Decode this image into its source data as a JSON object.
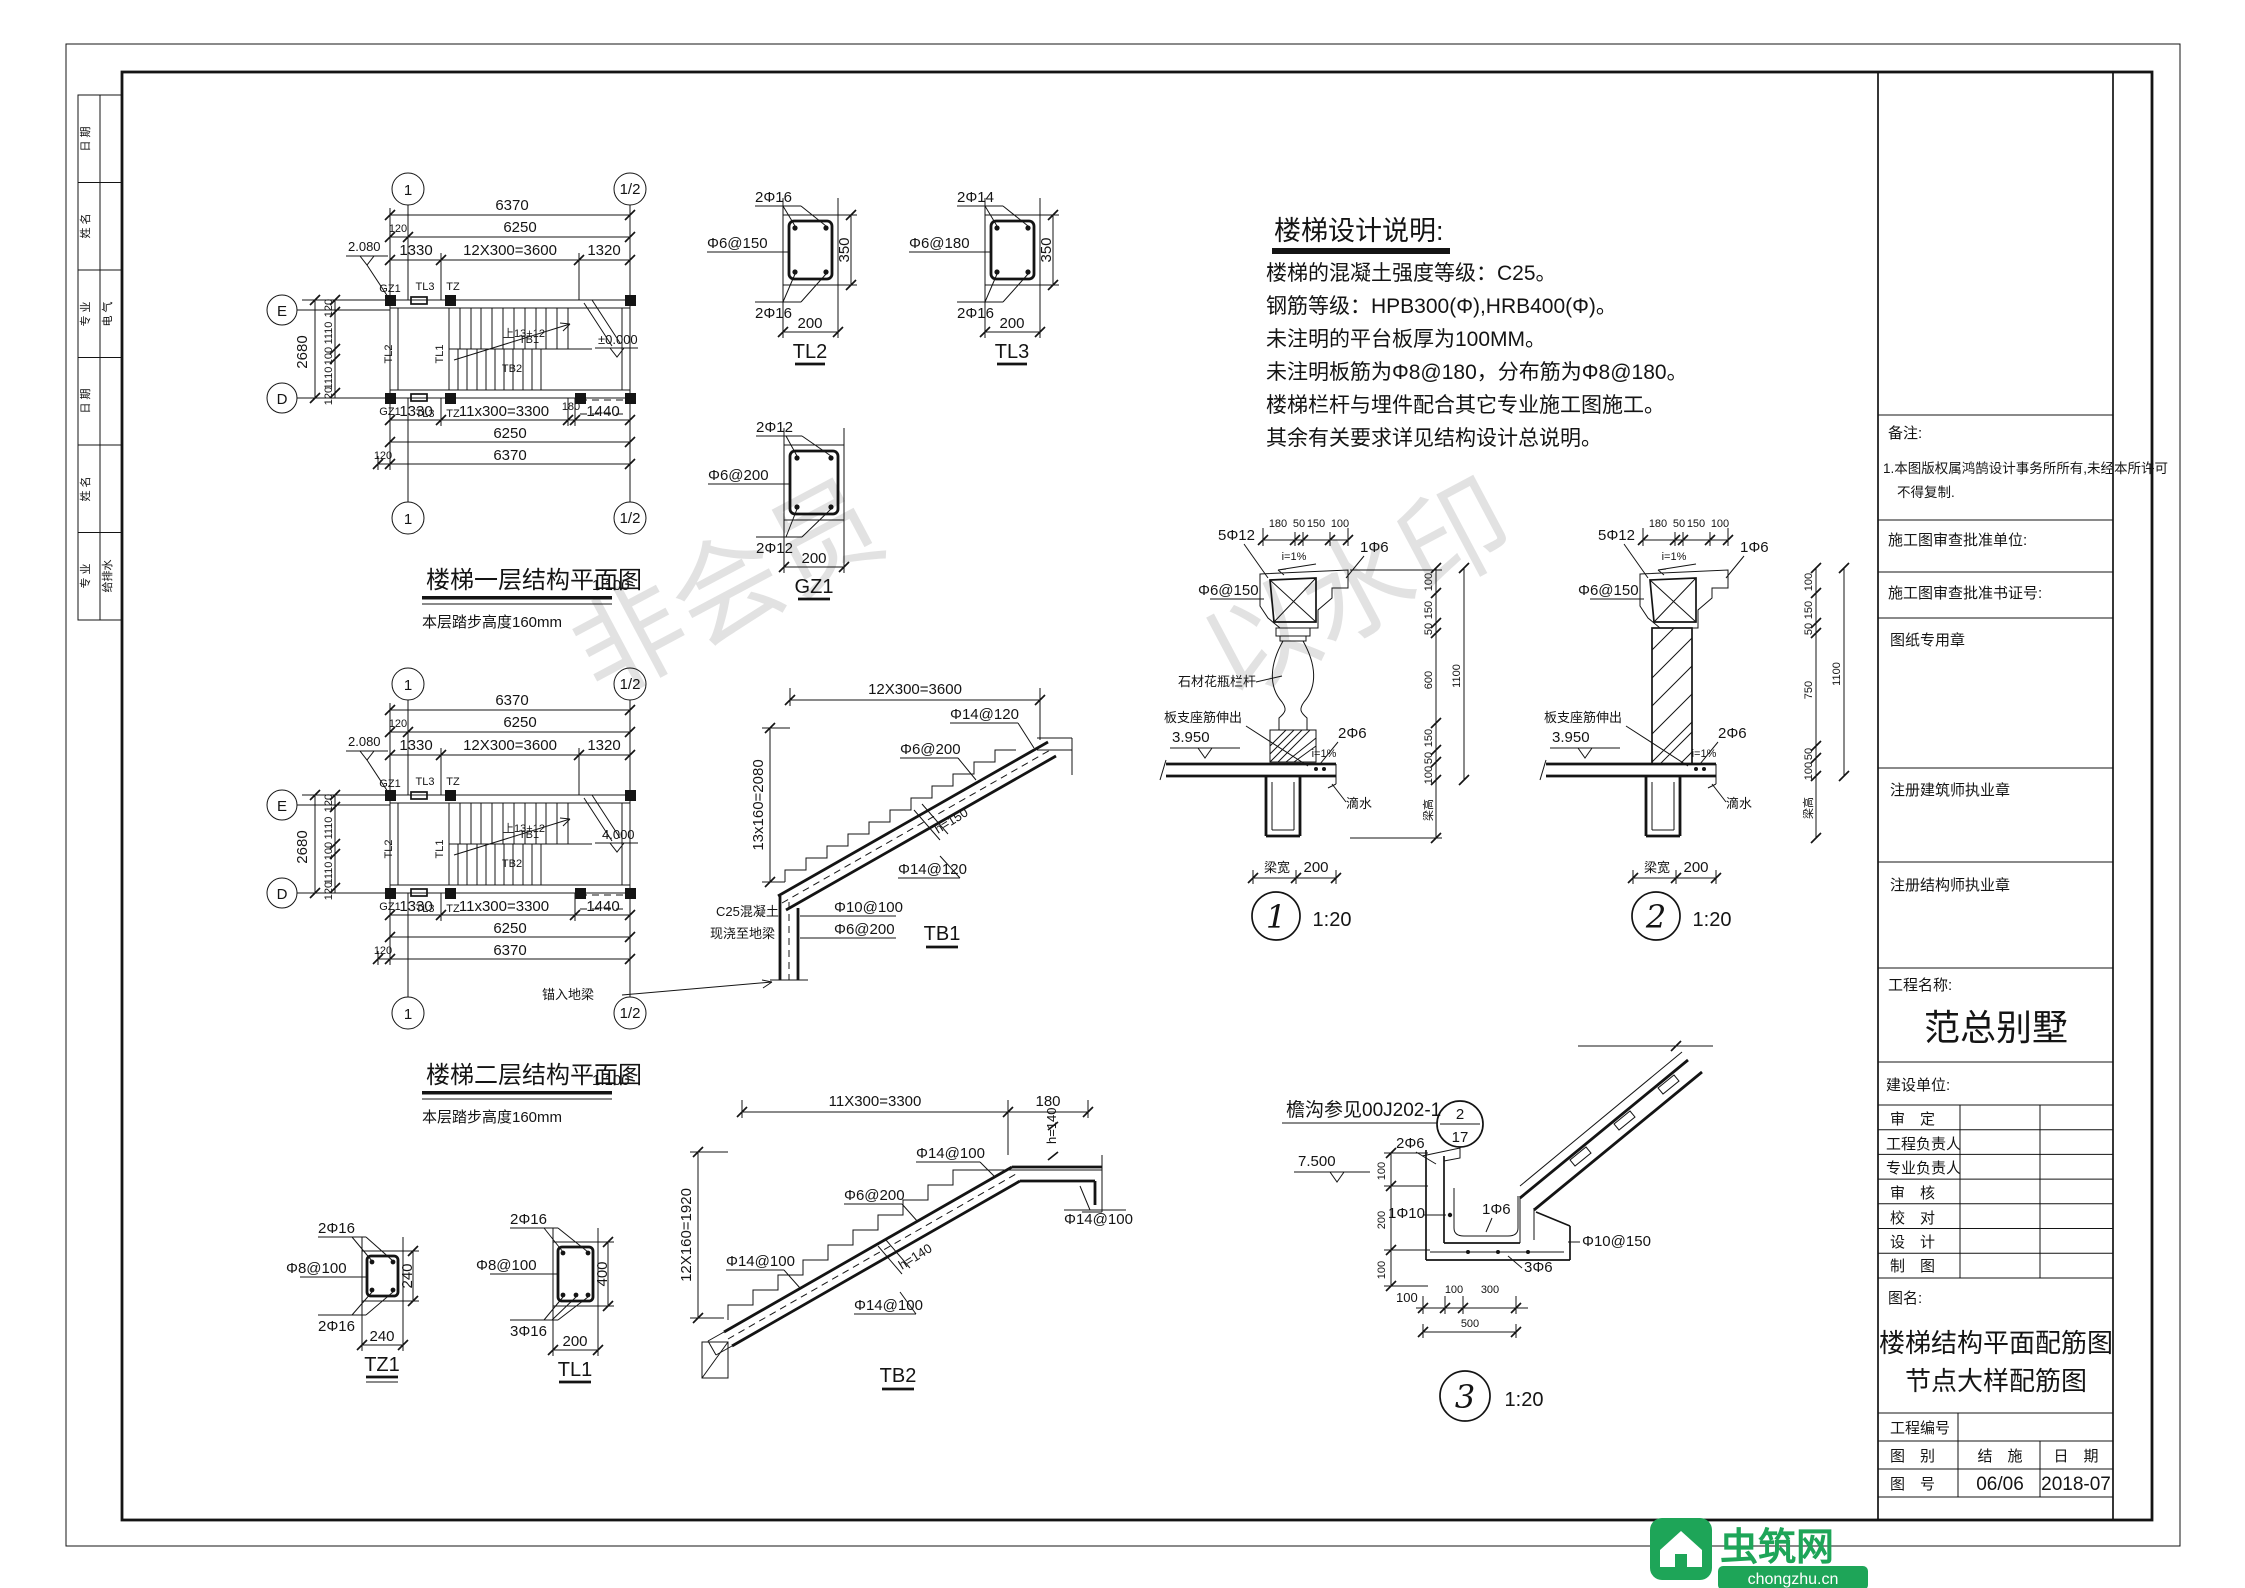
{
  "sheet": {
    "watermarks": [
      "非会员",
      "以水印"
    ]
  },
  "left_strip": {
    "rows": [
      {
        "label": "日 期",
        "value": ""
      },
      {
        "label": "姓 名",
        "value": ""
      },
      {
        "label": "专 业",
        "value": "电 气"
      },
      {
        "label": "日 期",
        "value": ""
      },
      {
        "label": "姓 名",
        "value": ""
      },
      {
        "label": "专 业",
        "value": "给排水"
      }
    ]
  },
  "plan_grid": {
    "one": "1",
    "half": "1/2",
    "e": "E",
    "d": "D"
  },
  "plan1": {
    "title": "楼梯一层结构平面图",
    "scale": "1:100",
    "subtitle": "本层踏步高度160mm",
    "elev": "2.080",
    "dims_top": [
      "6370",
      "120",
      "6250",
      "1330",
      "12X300=3600",
      "1320"
    ],
    "dims_left": [
      "2680",
      "120",
      "1110",
      "100",
      "1110",
      "120"
    ],
    "dims_bottom": [
      "1330",
      "11x300=3300",
      "180",
      "1440",
      "6250",
      "120",
      "6370"
    ],
    "labels": {
      "gz1": "GZ1",
      "tl3": "TL3",
      "tz": "TZ",
      "tl2": "TL2",
      "tl1": "TL1",
      "tb1": "TB1",
      "tb2": "TB2",
      "up": "上13+12",
      "level": "±0.000"
    }
  },
  "plan2": {
    "title": "楼梯二层结构平面图",
    "scale": "1:100",
    "subtitle": "本层踏步高度160mm",
    "elev": "2.080",
    "dims_top": [
      "6370",
      "120",
      "6250",
      "1330",
      "12X300=3600",
      "1320"
    ],
    "dims_left": [
      "2680",
      "120",
      "1110",
      "100",
      "1110",
      "120"
    ],
    "dims_bottom": [
      "1330",
      "11x300=3300",
      "",
      "1440",
      "6250",
      "120",
      "6370"
    ],
    "labels": {
      "gz1": "GZ1",
      "tl3": "TL3",
      "tz": "TZ",
      "tl2": "TL2",
      "tl1": "TL1",
      "tb1": "TB1",
      "tb2": "TB2",
      "up": "上13+12",
      "level": "4.000"
    }
  },
  "sections": {
    "tl2": {
      "top": "2Φ16",
      "stirrup": "Φ6@150",
      "h": "350",
      "bottom": "2Φ16",
      "w": "200",
      "name": "TL2"
    },
    "tl3": {
      "top": "2Φ14",
      "stirrup": "Φ6@180",
      "h": "350",
      "bottom": "2Φ16",
      "w": "200",
      "name": "TL3"
    },
    "gz1": {
      "top": "2Φ12",
      "stirrup": "Φ6@200",
      "bottom": "2Φ12",
      "w": "200",
      "name": "GZ1"
    },
    "tz1": {
      "top": "2Φ16",
      "stirrup": "Φ8@100",
      "h": "240",
      "bottom": "2Φ16",
      "w": "240",
      "name": "TZ1"
    },
    "tl1": {
      "top": "2Φ16",
      "stirrup": "Φ8@100",
      "h": "400",
      "bottom": "3Φ16",
      "w": "200",
      "name": "TL1"
    }
  },
  "tb1": {
    "dim_top": "12X300=3600",
    "dim_left": "13x160=2080",
    "bar_top": "Φ14@120",
    "stirrup": "Φ6@200",
    "h": "h=150",
    "bar_bot": "Φ14@120",
    "wall_bar1": "Φ10@100",
    "wall_bar2": "Φ6@200",
    "note1": "C25混凝土",
    "note2": "现浇至地梁",
    "note3": "锚入地梁",
    "name": "TB1"
  },
  "tb2": {
    "dim_top": "11X300=3300",
    "dim_top2": "180",
    "h_right": "h=140",
    "dim_left": "12X160=1920",
    "bar_top": "Φ14@100",
    "stirrup": "Φ6@200",
    "bar_left": "Φ14@100",
    "h_mid": "h=140",
    "bar_bot": "Φ14@100",
    "bar_right": "Φ14@100",
    "name": "TB2"
  },
  "notes": {
    "title": "楼梯设计说明:",
    "lines": [
      "楼梯的混凝土强度等级：C25。",
      "钢筋等级：HPB300(Φ),HRB400(Φ)。",
      "未注明的平台板厚为100MM。",
      "未注明板筋为Φ8@180，分布筋为Φ8@180。",
      "楼梯栏杆与埋件配合其它专业施工图施工。",
      "其余有关要求详见结构设计总说明。"
    ]
  },
  "detail1": {
    "dims_top": [
      "180",
      "50",
      "150",
      "100"
    ],
    "bars_top": "5Φ12",
    "slope": "i=1%",
    "bar16": "1Φ6",
    "stirrup": "Φ6@150",
    "baluster": "石材花瓶栏杆",
    "support": "板支座筋伸出",
    "elev": "3.950",
    "bars2": "2Φ6",
    "slope2": "i=1%",
    "drip": "滴水",
    "dims_right": [
      "100",
      "150",
      "50",
      "600",
      "150",
      "50",
      "100"
    ],
    "total_right": "1100",
    "beam_h": "梁高",
    "beam_w": "梁宽",
    "w": "200",
    "num": "1",
    "scale": "1:20"
  },
  "detail2": {
    "dims_top": [
      "180",
      "50",
      "150",
      "100"
    ],
    "bars_top": "5Φ12",
    "slope": "i=1%",
    "bar16": "1Φ6",
    "stirrup": "Φ6@150",
    "support": "板支座筋伸出",
    "elev": "3.950",
    "bars2": "2Φ6",
    "slope2": "i=1%",
    "drip": "滴水",
    "dims_right": [
      "100",
      "150",
      "50",
      "750",
      "50",
      "100"
    ],
    "total_right": "1100",
    "beam_h": "梁高",
    "beam_w": "梁宽",
    "w": "200",
    "num": "2",
    "scale": "1:20"
  },
  "detail3": {
    "ref": "檐沟参见00J202-1",
    "bubble_top": "2",
    "bubble_bot": "17",
    "elev": "7.500",
    "dims_left": [
      "100",
      "200",
      "100"
    ],
    "bars": [
      "2Φ6",
      "1Φ10",
      "1Φ6",
      "Φ10@150",
      "3Φ6"
    ],
    "dims_bottom": [
      "100",
      "100",
      "300"
    ],
    "total_bottom": "500",
    "num": "3",
    "scale": "1:20"
  },
  "titleblock": {
    "remark_label": "备注:",
    "remark1": "1.本图版权属鸿鹄设计事务所所有,未经本所许可",
    "remark2": "不得复制.",
    "review_unit": "施工图审查批准单位:",
    "review_no": "施工图审查批准书证号:",
    "stamp_drawing": "图纸专用章",
    "stamp_arch": "注册建筑师执业章",
    "stamp_struct": "注册结构师执业章",
    "project_label": "工程名称:",
    "project_name": "范总别墅",
    "client_label": "建设单位:",
    "sign_rows": [
      "审　定",
      "工程负责人",
      "专业负责人",
      "审　核",
      "校　对",
      "设　计",
      "制　图"
    ],
    "fig_label": "图名:",
    "fig_name1": "楼梯结构平面配筋图",
    "fig_name2": "节点大样配筋图",
    "proj_no_label": "工程编号",
    "cat_label": "图　别",
    "cat_value": "结　施",
    "date_label": "日　期",
    "no_label": "图　号",
    "no_value": "06/06",
    "date_value": "2018-07"
  },
  "logo": {
    "name": "虫筑网",
    "url": "chongzhu.cn"
  }
}
